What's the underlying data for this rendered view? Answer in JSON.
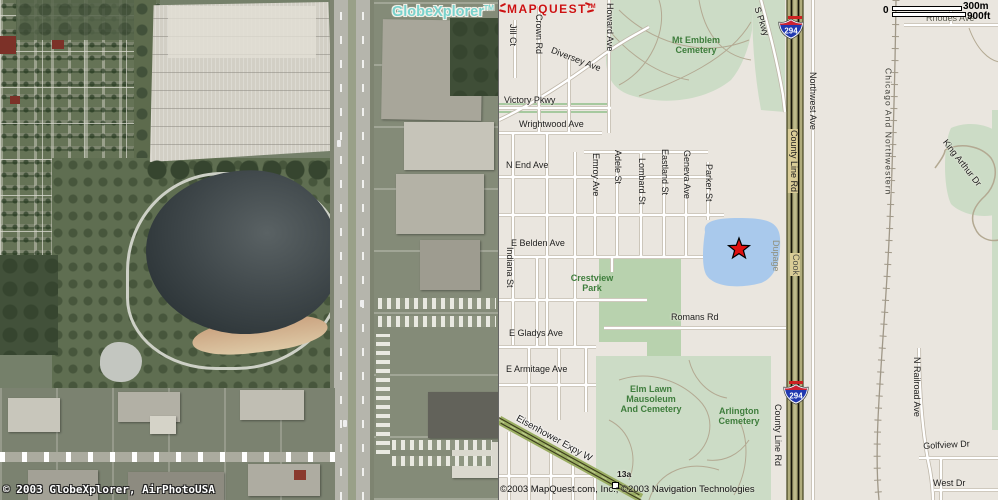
{
  "window": {
    "width": 998,
    "height": 500
  },
  "aerial": {
    "logo": {
      "brand": "GlobeXplorer",
      "tm": "TM"
    },
    "copyright": "© 2003 GlobeXplorer, AirPhotoUSA"
  },
  "map": {
    "logo": {
      "text": "MAPQUEST",
      "tm": "TM"
    },
    "copyright": "©2003 MapQuest.com, Inc.; ©2003 Navigation Technologies",
    "scale": {
      "zero": "0",
      "metric": "300m",
      "imperial": "900ft"
    },
    "marker": {
      "type": "destination-star",
      "x": 240,
      "y": 249
    },
    "shields": [
      {
        "label": "294",
        "x": 292,
        "y": 29
      },
      {
        "label": "294",
        "x": 297,
        "y": 394
      }
    ],
    "counties": [
      "Dupage",
      "Cook"
    ],
    "labels": [
      {
        "text": "Jill Ct",
        "x": 8,
        "y": 24,
        "rot": 90,
        "cls": ""
      },
      {
        "text": "Crown Rd",
        "x": 34,
        "y": 14,
        "rot": 90,
        "cls": ""
      },
      {
        "text": "Howard Ave",
        "x": 105,
        "y": 3,
        "rot": 90,
        "cls": ""
      },
      {
        "text": "Diversey Ave",
        "x": 54,
        "y": 46,
        "rot": 21,
        "cls": ""
      },
      {
        "text": "Victory Pkwy",
        "x": 5,
        "y": 96,
        "rot": 0,
        "cls": ""
      },
      {
        "text": "Wrightwood Ave",
        "x": 20,
        "y": 120,
        "rot": 0,
        "cls": ""
      },
      {
        "text": "N End Ave",
        "x": 7,
        "y": 161,
        "rot": 0,
        "cls": ""
      },
      {
        "text": "E Belden Ave",
        "x": 12,
        "y": 239,
        "rot": 0,
        "cls": ""
      },
      {
        "text": "Indiana St",
        "x": 5,
        "y": 247,
        "rot": 90,
        "cls": ""
      },
      {
        "text": "Emroy Ave",
        "x": 91,
        "y": 153,
        "rot": 90,
        "cls": ""
      },
      {
        "text": "Adele St",
        "x": 113,
        "y": 150,
        "rot": 90,
        "cls": ""
      },
      {
        "text": "Lombard St",
        "x": 137,
        "y": 158,
        "rot": 90,
        "cls": ""
      },
      {
        "text": "Eastland St",
        "x": 160,
        "y": 149,
        "rot": 90,
        "cls": ""
      },
      {
        "text": "Geneva Ave",
        "x": 182,
        "y": 150,
        "rot": 90,
        "cls": ""
      },
      {
        "text": "Parker St",
        "x": 204,
        "y": 164,
        "rot": 90,
        "cls": ""
      },
      {
        "text": "Romans Rd",
        "x": 172,
        "y": 313,
        "rot": 0,
        "cls": ""
      },
      {
        "text": "E Gladys Ave",
        "x": 10,
        "y": 329,
        "rot": 0,
        "cls": ""
      },
      {
        "text": "E Armitage Ave",
        "x": 7,
        "y": 365,
        "rot": 0,
        "cls": ""
      },
      {
        "text": "Rhodes Ave",
        "x": 427,
        "y": 14,
        "rot": 0,
        "cls": "gray"
      },
      {
        "text": "Golfview Dr",
        "x": 424,
        "y": 442,
        "rot": -3,
        "cls": ""
      },
      {
        "text": "West Dr",
        "x": 434,
        "y": 479,
        "rot": 0,
        "cls": ""
      },
      {
        "text": "S Pkwy",
        "x": 262,
        "y": 6,
        "rot": 72,
        "cls": ""
      },
      {
        "text": "Northwest Ave",
        "x": 308,
        "y": 72,
        "rot": 90,
        "cls": ""
      },
      {
        "text": "County Line Rd",
        "x": 289,
        "y": 129,
        "rot": 90,
        "cls": "box"
      },
      {
        "text": "County Line Rd",
        "x": 273,
        "y": 404,
        "rot": 90,
        "cls": ""
      },
      {
        "text": "N Railroad Ave",
        "x": 412,
        "y": 357,
        "rot": 90,
        "cls": ""
      },
      {
        "text": "Chicago And Northwestern",
        "x": 384,
        "y": 68,
        "rot": 90,
        "cls": "rail"
      },
      {
        "text": "King Arthur Dr",
        "x": 449,
        "y": 138,
        "rot": 52,
        "cls": ""
      },
      {
        "text": "Dupage",
        "x": 271,
        "y": 240,
        "rot": 90,
        "cls": "county"
      },
      {
        "text": "Cook",
        "x": 291,
        "y": 253,
        "rot": 90,
        "cls": "county cookbox"
      },
      {
        "text": "Mt Emblem\nCemetery",
        "x": 197,
        "y": 36,
        "rot": 0,
        "cls": "green center"
      },
      {
        "text": "Crestview\nPark",
        "x": 93,
        "y": 274,
        "rot": 0,
        "cls": "green center"
      },
      {
        "text": "Elm Lawn\nMausoleum\nAnd Cemetery",
        "x": 152,
        "y": 385,
        "rot": 0,
        "cls": "green center"
      },
      {
        "text": "Arlington\nCemetery",
        "x": 240,
        "y": 407,
        "rot": 0,
        "cls": "green center"
      },
      {
        "text": "Eisenhower Expy W",
        "x": 20,
        "y": 414,
        "rot": 29,
        "cls": "hwylabel"
      },
      {
        "text": "13a",
        "x": 118,
        "y": 470,
        "rot": 0,
        "cls": "exit"
      }
    ]
  },
  "colors": {
    "map_bg": "#eae6df",
    "cemetery_green": "#ccdcc6",
    "lake_blue": "#a9c9ec",
    "toll_road_khaki": "#b0ac7c",
    "toll_road_dark": "#4a4a28",
    "expressway_olive": "#9aad62",
    "shield_blue": "#2038b0",
    "shield_red": "#cc2233",
    "marker_red": "#e01010",
    "mapquest_red": "#cc1111",
    "globexplorer_cyan": "#79d2cc",
    "label_green": "#3e7d3c",
    "county_gray": "#8f8f7c"
  }
}
